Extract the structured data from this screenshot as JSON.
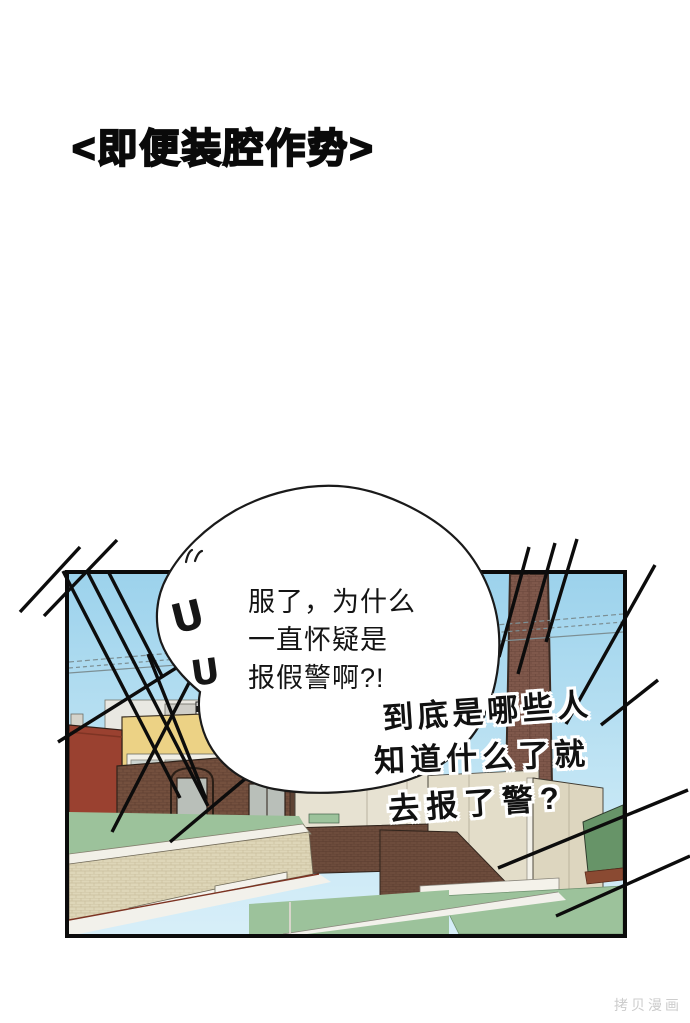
{
  "title": "<即便装腔作势>",
  "watermark": "拷贝漫画",
  "bubble": {
    "line1": "服了，为什么",
    "line2": "一直怀疑是",
    "line3": "报假警啊?!",
    "distress_mark": "U"
  },
  "shout": {
    "line1": "到底是哪些人",
    "line2": "知道什么了就",
    "line3": "去报了警?"
  },
  "colors": {
    "sky_top": "#9cd2ec",
    "sky_bottom": "#d7eef8",
    "roof_green": "#9cc29b",
    "dark_roof_green": "#679468",
    "brick_brown": "#74503e",
    "brick_dark_brown": "#6d4c3c",
    "brick_red_building": "#9a4130",
    "building_yellow": "#ecd285",
    "wall_cream": "#e3ddc9",
    "parapet_tan": "#ded6b8",
    "chimney_brown": "#7d564a",
    "awning_red": "#b23b2c",
    "trim_rust": "#7c3322",
    "line_black": "#0c0c0c",
    "panel_border": "#0b0b0b"
  }
}
